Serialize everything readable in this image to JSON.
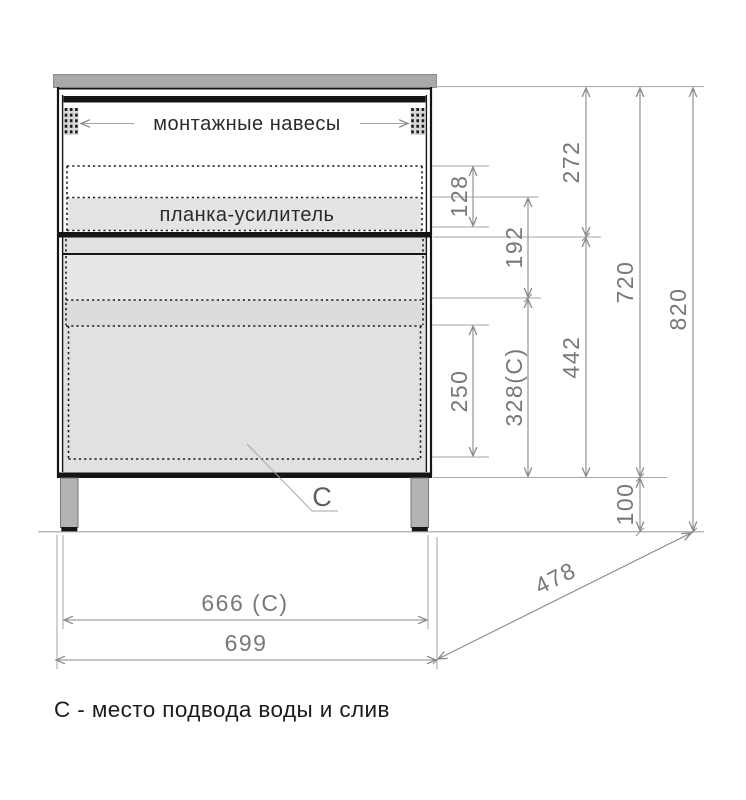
{
  "drawing": {
    "caption": "С - место подвода воды и слив",
    "labels": {
      "hangers": "монтажные навесы",
      "plank": "планка-усилитель",
      "drain": "C"
    },
    "dims": {
      "v272": "272",
      "v128": "128",
      "v192": "192",
      "v250": "250",
      "v328": "328(C)",
      "v442": "442",
      "v720": "720",
      "v820": "820",
      "v100": "100",
      "h666": "666 (C)",
      "h699": "699",
      "d478": "478"
    },
    "colors": {
      "outline": "#151515",
      "dim_line": "#8a8a8a",
      "dim_text": "#787878",
      "countertop": "#a9a9a9",
      "leg": "#b3b3b3",
      "leg_edge": "#6e6e6e",
      "panel": "#e1e1e1",
      "panel_light": "#e7e7e7",
      "panel_mid": "#dcdcdc",
      "strip": "#e4e4e4",
      "hanger": "#d8d8d8"
    }
  }
}
